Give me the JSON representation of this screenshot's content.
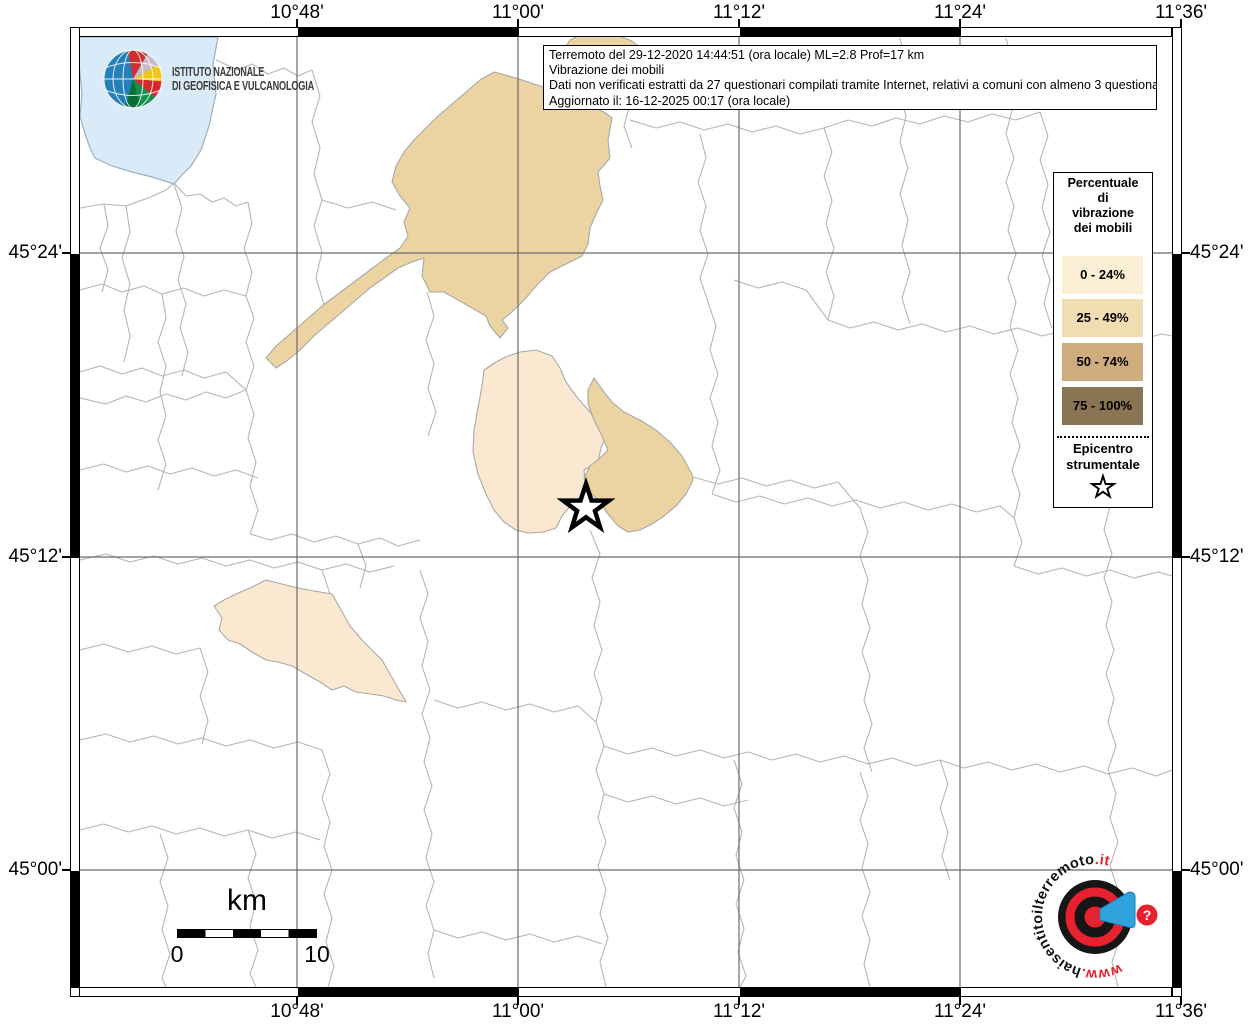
{
  "axes": {
    "top": [
      "10°48'",
      "11°00'",
      "11°12'",
      "11°24'",
      "11°36'"
    ],
    "bottom": [
      "10°48'",
      "11°00'",
      "11°12'",
      "11°24'",
      "11°36'"
    ],
    "left": [
      "45°24'",
      "45°12'",
      "45°00'"
    ],
    "right": [
      "45°24'",
      "45°12'",
      "45°00'"
    ]
  },
  "info_box": {
    "line1": "Terremoto del 29-12-2020 14:44:51 (ora locale) ML=2.8 Prof=17 km",
    "line2": "Vibrazione dei mobili",
    "line3": "Dati non verificati estratti da 27 questionari compilati tramite Internet, relativi a comuni con almeno 3 questionari.",
    "line4": "Aggiornato il: 16-12-2025 00:17 (ora locale)"
  },
  "legend": {
    "title": "Percentuale di vibrazione dei mobili",
    "classes": [
      {
        "label": "0 - 24%",
        "color": "#FCEDD5"
      },
      {
        "label": "25 - 49%",
        "color": "#F2DDB2"
      },
      {
        "label": "50 - 74%",
        "color": "#CEAC7D"
      },
      {
        "label": "75 - 100%",
        "color": "#8B7454"
      }
    ],
    "epicenter_label": "Epicentro strumentale"
  },
  "scale_bar": {
    "unit": "km",
    "start": "0",
    "end": "10"
  },
  "ingv_logo": {
    "line1": "ISTITUTO NAZIONALE",
    "line2": "DI GEOFISICA E VULCANOLOGIA"
  },
  "hsit_logo": {
    "prefix": "www.",
    "name": "haisentitoilterremoto",
    "tld": ".it",
    "question_mark": "?"
  },
  "map": {
    "water_color": "#D9EAF8",
    "class_0_24_color": "#FBE8D1",
    "class_25_49_color": "#EBD3A2",
    "boundary_color": "#b5b5b5",
    "grid_color": "#6b6b6b"
  }
}
